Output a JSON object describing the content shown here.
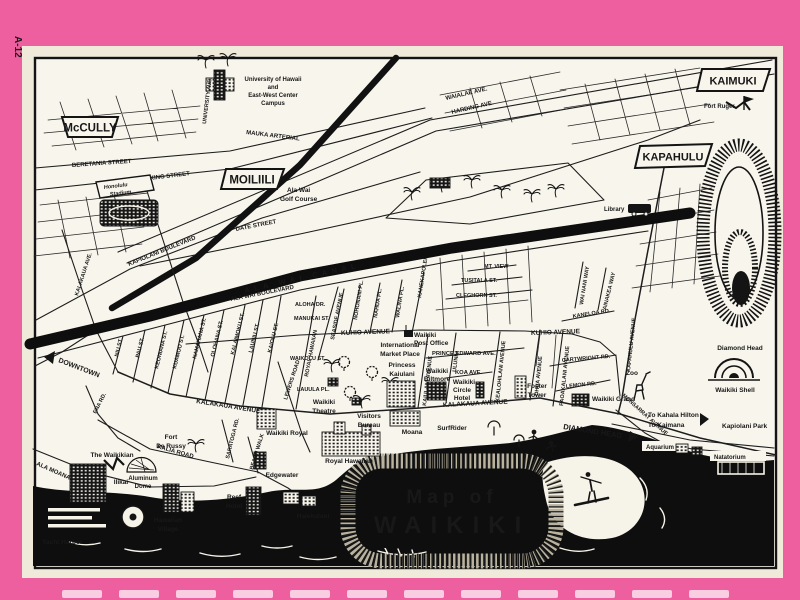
{
  "page": {
    "side_label": "A-12"
  },
  "colors": {
    "border_pink": "#ee5fa0",
    "page_cream": "#efead9",
    "map_paper": "#f8f5ec",
    "ink": "#141414",
    "ocean_black": "#0e0e0e",
    "lei_gray": "#b9b29e",
    "edge_dash_pink": "#f9cde2"
  },
  "title": {
    "line1": "Map of",
    "line2": "WAIKIKI"
  },
  "banners": {
    "mccully": "McCULLY",
    "moiliili": "MOILIILI",
    "kaimuki": "KAIMUKI",
    "kapahulu": "KAPAHULU"
  },
  "labels": {
    "university_1": "University of Hawaii",
    "university_2": "and",
    "university_3": "East-West Center",
    "university_4": "Campus",
    "university_ave": "UNIVERSITY AVE.",
    "mauka_arterial": "MAUKA ARTERIAL",
    "waialae_ave": "WAIALAE AVE.",
    "harding_ave": "HARDING AVE.",
    "beretania": "BERETANIA STREET",
    "king": "KING STREET",
    "date": "DATE STREET",
    "kapiolani_blvd": "KAPIOLANI BOULEVARD",
    "honolulu_stadium_1": "Honolulu",
    "honolulu_stadium_2": "Stadium",
    "ala_wai_canal": "ALA WAI CANAL",
    "ala_wai_blvd": "ALA WAI BOULEVARD",
    "golf_1": "Ala Wai",
    "golf_2": "Golf Course",
    "library": "Library",
    "fort_ruger": "Fort Ruger",
    "diamond_head_crater": "Diamond Head",
    "downtown": "DOWNTOWN",
    "kalakaua_ave_n": "KALAKAUA AVE.",
    "niu": "NIU ST.",
    "pau": "PAU ST.",
    "keoniana": "KEONIANA ST.",
    "kuamoo": "KUAMOO ST.",
    "namahana": "NAMAHANA ST.",
    "olohana": "OLOHANA ST.",
    "kalaimoku": "KALAIMOKU ST.",
    "launiu": "LAUNIU ST.",
    "kaiolu": "KAIOLU ST.",
    "aloha_dr": "ALOHA DR.",
    "manukai": "MANUKAI ST.",
    "royal_hawaiian_ave": "ROYAL HAWAIIAN",
    "seaside": "SEASIDE AVENUE",
    "waikolu": "WAIKOLU ST.",
    "lauula": "LAUULA PL.",
    "lewers": "LEWERS ROAD",
    "nohonani": "NOHONANI PL.",
    "nahua": "NAHUA PL.",
    "walina": "WALINA PL.",
    "kanekapolei": "KANEKAPOLEI",
    "kuhio_w": "KUHIO AVENUE",
    "kuhio_e": "KUHIO AVENUE",
    "mt_view": "MT. VIEW",
    "tusitala": "TUSITALA ST.",
    "cleghorn": "CLEGHORN ST.",
    "kaneloa": "KANELOA RD.",
    "wai_nani": "WAI NANI WAY",
    "ainakea": "AINAKEA WAY",
    "prince_edward": "PRINCE EDWARD AVE.",
    "koa": "KOA AVE.",
    "kaiulani_ave": "KAIULANI AVENUE",
    "uluniu": "ULUNIU",
    "kealohilani": "KEALOHILANI AVENUE",
    "ohua": "OHUA AVENUE",
    "paoakalani": "PAOAKALANI AVENUE",
    "cartwright": "CARTWRIGHT RD.",
    "lemon": "LEMON RD.",
    "kapahulu_ave": "KAPAHULU AVENUE",
    "monsarrat": "MONSARRAT AVENUE",
    "kalakaua_mid": "KALAKAUA AVENUE",
    "kalakaua_e": "KALAKAUA AVENUE",
    "kalia": "KALIA ROAD",
    "saratoga": "SARATOGA RD.",
    "beach_walk": "BEACH WALK",
    "ena": "ENA RD.",
    "ala_moana": "ALA MOANA",
    "diamond_head_road": "DIAMOND HEAD",
    "to_kahala": "To Kahala Hilton",
    "to_kaimana": "To Kaimana",
    "kapiolani_park": "Kapiolani Park",
    "aquarium": "Aquarium",
    "natatorium": "Natatorium",
    "waikiki_shell": "Waikiki Shell",
    "zoo": "Zoo",
    "post_office_1": "Waikiki",
    "post_office_2": "Post Office",
    "intl_market_1": "International",
    "intl_market_2": "Market Place",
    "princess_1": "Princess",
    "princess_2": "Kaiulani",
    "biltmore_1": "Waikiki",
    "biltmore_2": "Biltmore",
    "circle_1": "Waikiki",
    "circle_2": "Circle",
    "circle_3": "Hotel",
    "foster_1": "Foster",
    "foster_2": "Tower",
    "waikiki_grand": "Waikiki Grand",
    "theatre_1": "Waikiki",
    "theatre_2": "Theatre",
    "visitors_1": "Visitors",
    "visitors_2": "Bureau",
    "moana": "Moana",
    "surfrider": "SurfRider",
    "royal_hawaiian": "Royal Hawaiian",
    "waikiki_royal": "Waikiki Royal",
    "edgewater": "Edgewater",
    "reef_1": "Reef",
    "reef_2": "Hotel",
    "halekulani": "Halekulani",
    "fort_derussy_1": "Fort",
    "fort_derussy_2": "De Russy",
    "waikikian": "The Waikikian",
    "ilikai": "Ilikai",
    "aluminum_1": "Aluminum",
    "aluminum_2": "Dome",
    "hawaiian_village_1": "Hawaiian",
    "hawaiian_village_2": "Village",
    "yacht_harbor": "Yacht Harbor"
  }
}
